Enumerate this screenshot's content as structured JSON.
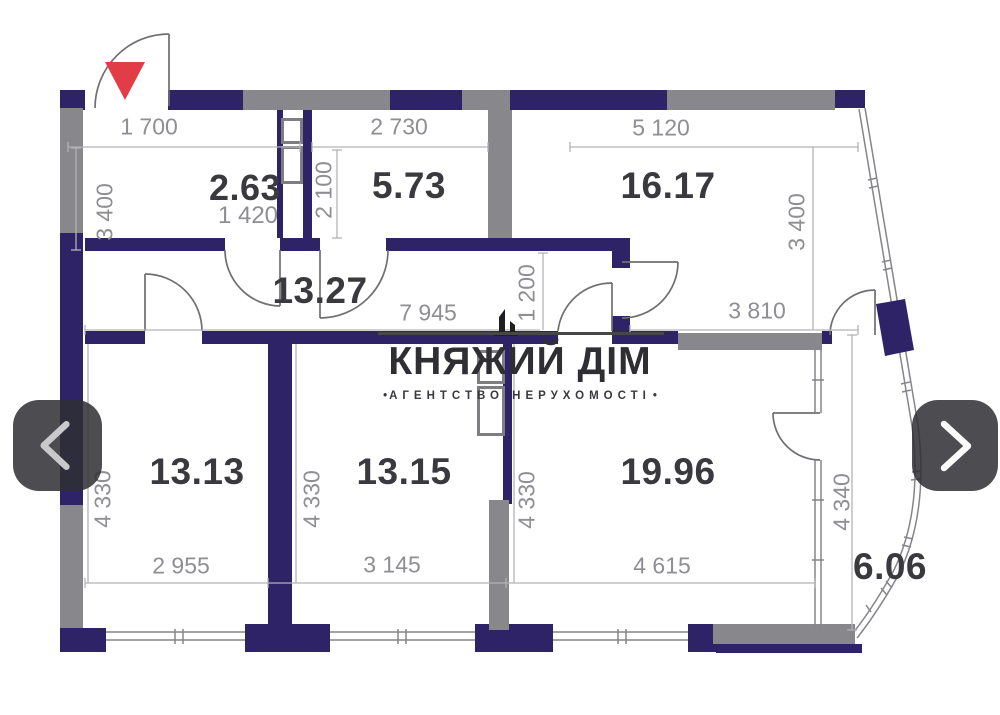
{
  "logo": {
    "title": "КНЯЖИЙ ДІМ",
    "subtitle": "АГЕНТСТВО НЕРУХОМОСТІ",
    "bullet": "•",
    "icon": "building-icon"
  },
  "carousel": {
    "prev_icon": "chevron-left-icon",
    "next_icon": "chevron-right-icon"
  },
  "rooms": {
    "r263": "2.63",
    "r573": "5.73",
    "r1617": "16.17",
    "r1327": "13.27",
    "r1313": "13.13",
    "r1315": "13.15",
    "r1996": "19.96",
    "r606": "6.06"
  },
  "dimensions": {
    "top_left": "1 700",
    "top_mid": "2 730",
    "top_right": "5 120",
    "left_v": "3 400",
    "right_v": "3 400",
    "shaft_v": "2 100",
    "r263_w": "1 420",
    "hall_w": "7 945",
    "hall_v": "1 200",
    "hall_right_w": "3 810",
    "low_left_v": "4 330",
    "low_mid_v": "4 330",
    "low_mid2_v": "4 330",
    "low_right_v": "4 340",
    "low_left_w": "2 955",
    "low_mid_w": "3 145",
    "low_right_w": "4 615"
  },
  "colors": {
    "wall_navy": "#2e2366",
    "wall_gray": "#87878c",
    "accent_red": "#e23c46",
    "dim_text": "#8e8e93",
    "area_text": "#3a3a3e"
  }
}
